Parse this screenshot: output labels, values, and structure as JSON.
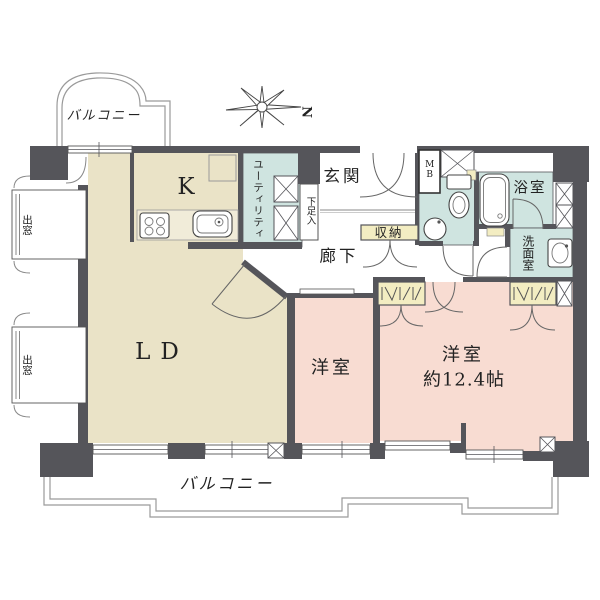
{
  "floorplan": {
    "compass": {
      "north_label": "N"
    },
    "rooms": {
      "balcony_top": {
        "label": "バルコニー"
      },
      "balcony_bottom": {
        "label": "バルコニー"
      },
      "living_dining": {
        "label": "LD"
      },
      "kitchen": {
        "label": "K"
      },
      "utility": {
        "label": "ユーティリティ"
      },
      "entrance": {
        "label": "玄関"
      },
      "shoe_cabinet": {
        "label": "下足入"
      },
      "meter_box": {
        "label": "MB"
      },
      "storage": {
        "label": "収納"
      },
      "hallway": {
        "label": "廊下"
      },
      "bathroom": {
        "label": "浴室"
      },
      "washroom": {
        "label": "洗面室"
      },
      "bedroom_small": {
        "label": "洋室"
      },
      "bedroom_large": {
        "label": "洋室",
        "size_label": "約12.4帖"
      },
      "bay_window_upper": {
        "label": "出窓"
      },
      "bay_window_lower": {
        "label": "出窓"
      }
    },
    "colors": {
      "wall": "#55555a",
      "room-beige": "#eae3c7",
      "room-pink": "#f8dcd2",
      "room-blue": "#cfe4e0",
      "closet-yellow": "#f3edc2",
      "outline-gray": "#9a9a9a"
    }
  }
}
